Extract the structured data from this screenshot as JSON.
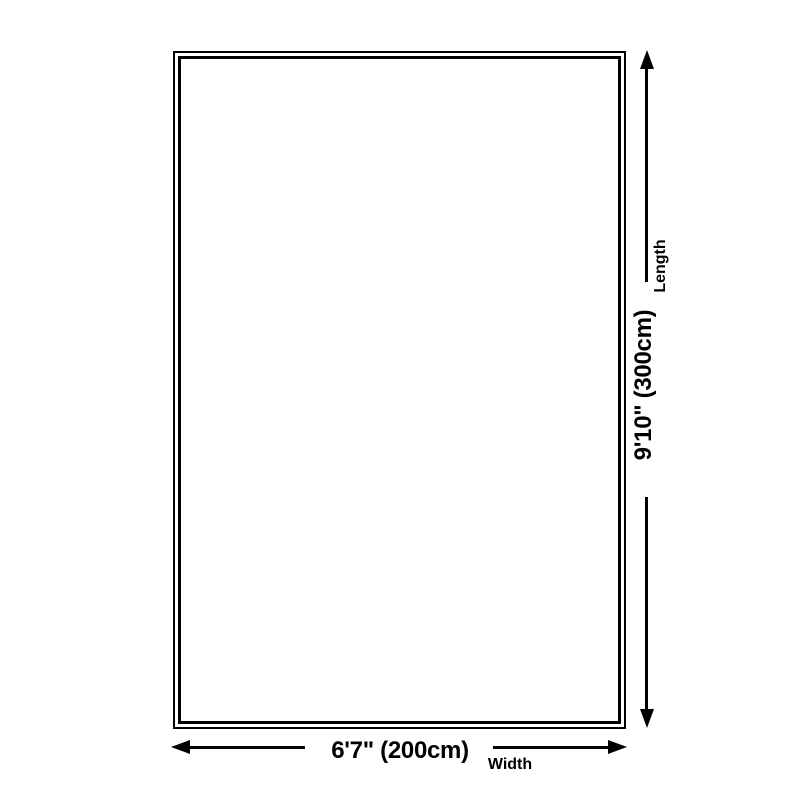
{
  "diagram": {
    "kind": "product-size-diagram",
    "length": {
      "value": "9'10\" (300cm)",
      "label": "Length"
    },
    "width": {
      "value": "6'7\" (200cm)",
      "label": "Width"
    },
    "colors": {
      "ink": "#000000",
      "background": "#ffffff"
    }
  }
}
